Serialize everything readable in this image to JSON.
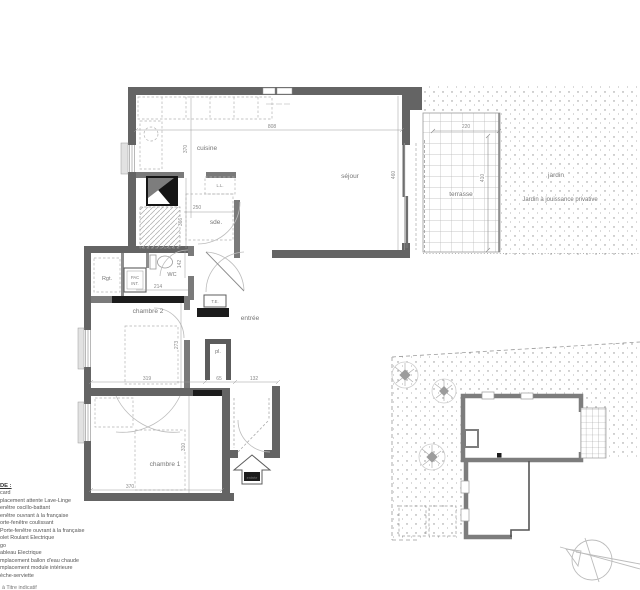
{
  "floor_plan": {
    "rooms": {
      "cuisine": "cuisine",
      "sejour": "séjour",
      "sde": "sde.",
      "wc": "WC",
      "rgt": "Rgt.",
      "rgt_dim": "71",
      "pac_line1": "PAC",
      "pac_line2": "INT.",
      "te": "T.E.",
      "ll": "L.L.",
      "entree": "entrée",
      "placard": "pl.",
      "chambre2": "chambre 2",
      "chambre1": "chambre 1",
      "terrasse": "terrasse",
      "jardin": "jardin",
      "jardin_note": "Jardin à jouissance privative",
      "entrance_tag": "entrée"
    },
    "dimensions": {
      "top_width": "808",
      "cuisine_depth": "370",
      "sejour_depth": "460",
      "terrasse_width": "220",
      "terrasse_depth": "410",
      "sde_width": "250",
      "sde_depth": "366",
      "wc_depth": "142",
      "wc_width": "214",
      "chambre2_width": "319",
      "chambre2_depth": "273",
      "placard_width": "65",
      "hall_width": "132",
      "chambre1_width": "370",
      "chambre1_depth": "310"
    }
  },
  "legend": {
    "heading": "DE :",
    "items": [
      "card",
      "placement attente Lave-Linge",
      "enêtre oscillo-battant",
      "enêtre ouvrant à la française",
      "orte-fenêtre coulissant",
      "Porte-fenêtre ouvrant à la française",
      "olet Roulant Electrique",
      "go",
      "ableau Electrique",
      "mplacement ballon d'eau chaude",
      "mplacement module intérieure",
      "èche-serviette"
    ],
    "footnote": "à Titre indicatif"
  }
}
